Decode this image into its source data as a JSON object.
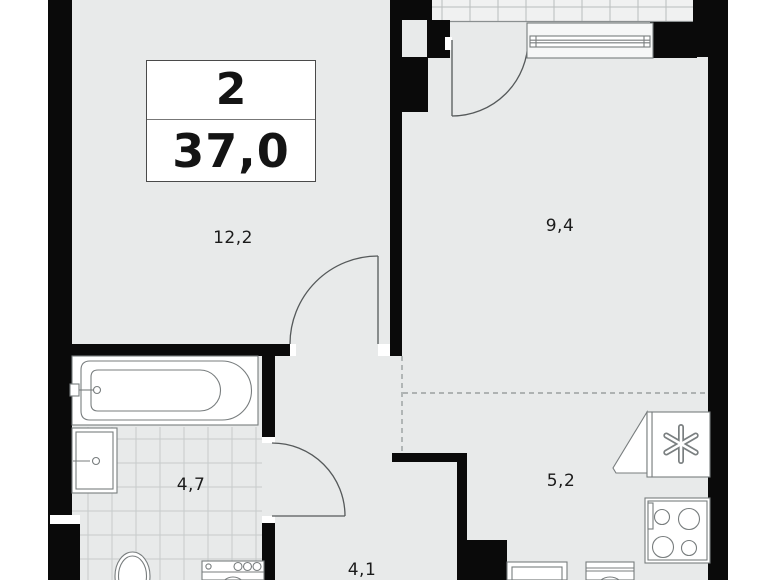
{
  "floorplan": {
    "info_box": {
      "room_count": "2",
      "total_area": "37,0"
    },
    "rooms": {
      "living_room_area": "12,2",
      "bedroom_area": "9,4",
      "bathroom_area": "4,7",
      "kitchen_area": "5,2",
      "hallway_area": "4,1"
    },
    "colors": {
      "walls": "#0a0a0a",
      "floor": "#e8eaea",
      "balcony_floor": "#f0f1f1",
      "fixture_outline": "#787d7e",
      "background": "#ffffff"
    }
  }
}
